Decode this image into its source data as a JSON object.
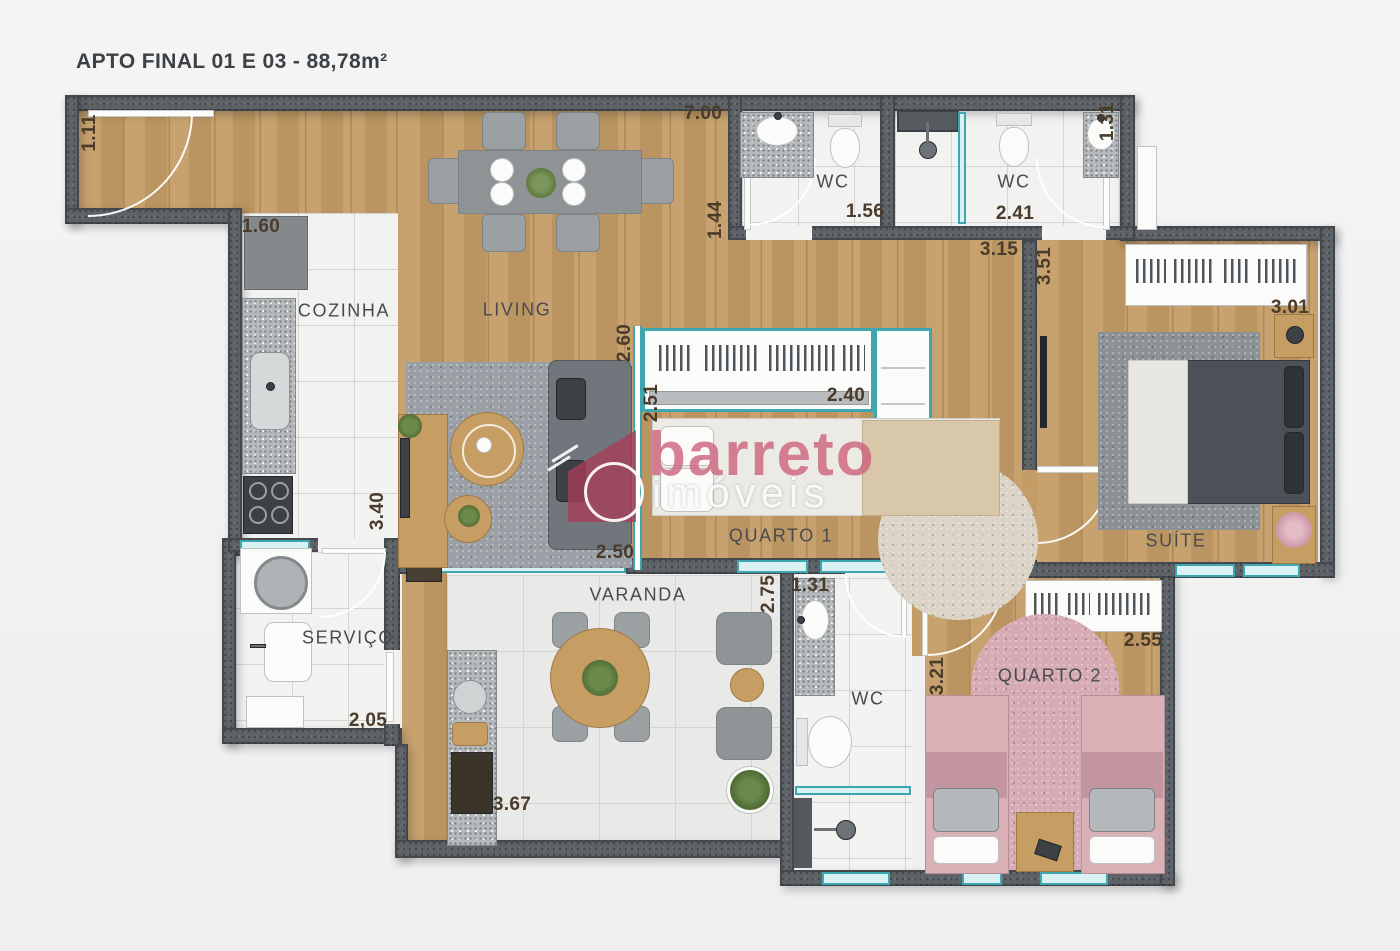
{
  "title": "APTO FINAL 01 E 03 - 88,78m²",
  "watermark": {
    "brand": "barreto",
    "subtitle": "imóveis"
  },
  "rooms": [
    "COZINHA",
    "LIVING",
    "WC",
    "WC",
    "QUARTO 1",
    "SUÍTE",
    "SERVIÇO",
    "VARANDA",
    "WC",
    "QUARTO 2"
  ],
  "dims": [
    "1.11",
    "7.00",
    "1.44",
    "1.56",
    "2.41",
    "1.31",
    "1.60",
    "3.15",
    "3.51",
    "3.01",
    "2.60",
    "2.51",
    "2.40",
    "3.40",
    "2.50",
    "2,05",
    "3.67",
    "2.75",
    "1.31",
    "2.55",
    "3.21"
  ],
  "colors": {
    "bg": "#f1f1f2",
    "wall": "#5d6267",
    "wood": "#c49c66",
    "tile": "#f2f2f0",
    "vtile": "#e9e9e7",
    "teal": "#3ea6ae",
    "granite": "#b6babc",
    "labelc": "#474b4f",
    "dimc": "#4a3b2b",
    "wmpink": "#cd627c",
    "q2pink": "#d6aeb5"
  }
}
